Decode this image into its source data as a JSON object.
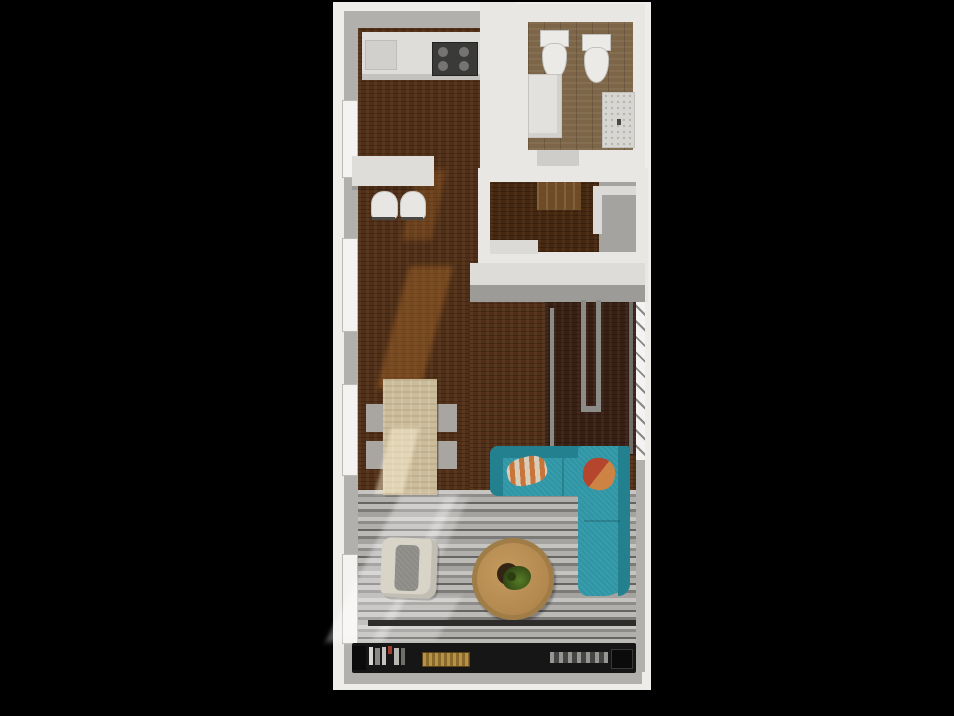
{
  "scene": {
    "title": "apartment-floor-plan-3d-top-view-render",
    "description": "Top-down 3D rendered floor plan of a narrow apartment on a black background",
    "background": "#000000"
  },
  "colors": {
    "background": "#000000",
    "plan_bg": "#efedea",
    "wall_gray": "#b2b0ad",
    "wall_light": "#dedcd9",
    "wall_dark": "#9d9b98",
    "wall_white": "#e9e7e4",
    "kitchen_floor": "#512f16",
    "bathroom_floor": "#7d6547",
    "entry_floor": "#46270f",
    "stair_floor": "#371f13",
    "living_floor": "#9b9996",
    "counter": "#dfddda",
    "counter_edge": "#c4c2bf",
    "cooktop": "#3a3a38",
    "appliance": "#d2d0cd",
    "stool": "#e8e6e2",
    "stool_leg": "#4a4845",
    "toilet": "#eceae7",
    "vanity": "#e3e1de",
    "stone_counter": "#d8d6d2",
    "door": "#cfcdc9",
    "mat": "#6e4b26",
    "closet": "#a5a3a0",
    "trim": "#dcdad7",
    "rail": "#8d8b88",
    "rail_dark": "#6f6d6a",
    "window": "#f4f3f1",
    "table": "#cbbc9b",
    "chair": "#a9a5a0",
    "sofa": "#2e95a5",
    "sofa_dark": "#23808f",
    "pillow_cream": "#d8cdb8",
    "pillow_orange": "#c9753a",
    "pillow_red": "#b5452c",
    "coffee_table": "#b78d55",
    "coffee_table_rim": "#a07c46",
    "table_hole": "#332414",
    "plant": "#47601f",
    "plant_dark": "#2c3d12",
    "armchair": "#d8d4c8",
    "armchair_cushion": "#8d8b86",
    "console": "#161616",
    "console_block": "#0b0b0b",
    "shelf_line": "#2e2c2a",
    "gold": "#8a6a2c",
    "electronics": "#454543",
    "books": [
      "#d8d6d2",
      "#8a8886",
      "#c4c2bf",
      "#a33b2e",
      "#b8b6b3",
      "#706e6b"
    ]
  },
  "rooms": [
    {
      "name": "kitchen",
      "floor": "dark walnut wood",
      "items": [
        "counter",
        "range-cooktop",
        "appliance"
      ]
    },
    {
      "name": "bathroom",
      "floor": "brown oak planks",
      "items": [
        "toilet",
        "toilet",
        "vanity-cabinet",
        "stone-counter",
        "door"
      ]
    },
    {
      "name": "entry-hall",
      "floor": "dark walnut wood",
      "items": [
        "door-mat",
        "closet"
      ]
    },
    {
      "name": "dining-area",
      "floor": "dark walnut wood",
      "items": [
        "breakfast-counter",
        "bar-stool",
        "bar-stool",
        "dining-table",
        "chair",
        "chair",
        "chair",
        "chair"
      ]
    },
    {
      "name": "stairwell",
      "floor": "mahogany",
      "items": [
        "railing-left",
        "railing-u",
        "railing-right",
        "window"
      ]
    },
    {
      "name": "living-room",
      "floor": "gray striped wood planks",
      "items": [
        "sectional-sofa",
        "pillow",
        "pillow",
        "coffee-table",
        "potted-plant",
        "armchair",
        "tv-console",
        "books",
        "gold-decor-box",
        "electronics"
      ]
    }
  ],
  "counts": {
    "toilets": 2,
    "bar_stools": 2,
    "dining_chairs": 4,
    "sofa_pillows": 2,
    "windows_left_wall": 4
  }
}
